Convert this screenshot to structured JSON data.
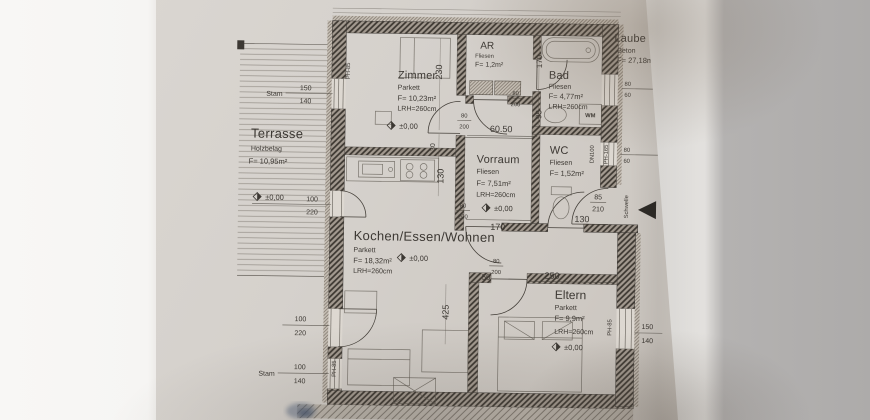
{
  "photo": {
    "background_left": "#f6f5f3",
    "paper_color": "#d5d1cc",
    "background_right": "#adabaa",
    "line_color": "#3c3833"
  },
  "rooms": {
    "terrasse": {
      "name": "Terrasse",
      "finish": "Holzbelag",
      "area": "F= 10,95m²"
    },
    "zimmer": {
      "name": "Zimmer",
      "finish": "Parkett",
      "area": "F= 10,23m²",
      "height": "LRH=260cm"
    },
    "ar": {
      "name": "AR",
      "finish": "Fliesen",
      "area": "F= 1,2m²"
    },
    "bad": {
      "name": "Bad",
      "finish": "Fliesen",
      "area": "F= 4,77m²",
      "height": "LRH=260cm"
    },
    "vorraum": {
      "name": "Vorraum",
      "finish": "Fliesen",
      "area": "F= 7,51m²",
      "height": "LRH=260cm"
    },
    "wc": {
      "name": "WC",
      "finish": "Fliesen",
      "area": "F= 1,52m²"
    },
    "wohnen": {
      "name": "Kochen/Essen/Wohnen",
      "finish": "Parkett",
      "area": "F= 18,32m²",
      "height": "LRH=260cm"
    },
    "eltern": {
      "name": "Eltern",
      "finish": "Parkett",
      "area": "F= 9,9m²",
      "height": "LRH=260cm"
    },
    "laube": {
      "name": "Laube",
      "finish": "Beton",
      "area": "F= 27,18m²"
    }
  },
  "levels": {
    "zero": "±0,00"
  },
  "dims": {
    "stam": "Stam",
    "win150_t": "150",
    "win150_b": "140",
    "door100_t": "100",
    "door100_b": "220",
    "win100_t": "100",
    "win100_b": "140",
    "d80": "80",
    "d200": "200",
    "d85": "85",
    "d210": "210",
    "v80": "80",
    "v60": "60",
    "hall": "60.50",
    "c230": "230",
    "c30": "30",
    "c130": "130",
    "c425": "425",
    "ar170": "170",
    "bad95": "95",
    "vor170": "170",
    "wc130": "130",
    "el250": "250",
    "el50": "50"
  },
  "wall_labels": {
    "ph85": "PH-85",
    "ph165": "PH-165",
    "dn100": "DN100",
    "schwelle": "Schwelle"
  },
  "fixtures": {
    "wm": "WM"
  }
}
